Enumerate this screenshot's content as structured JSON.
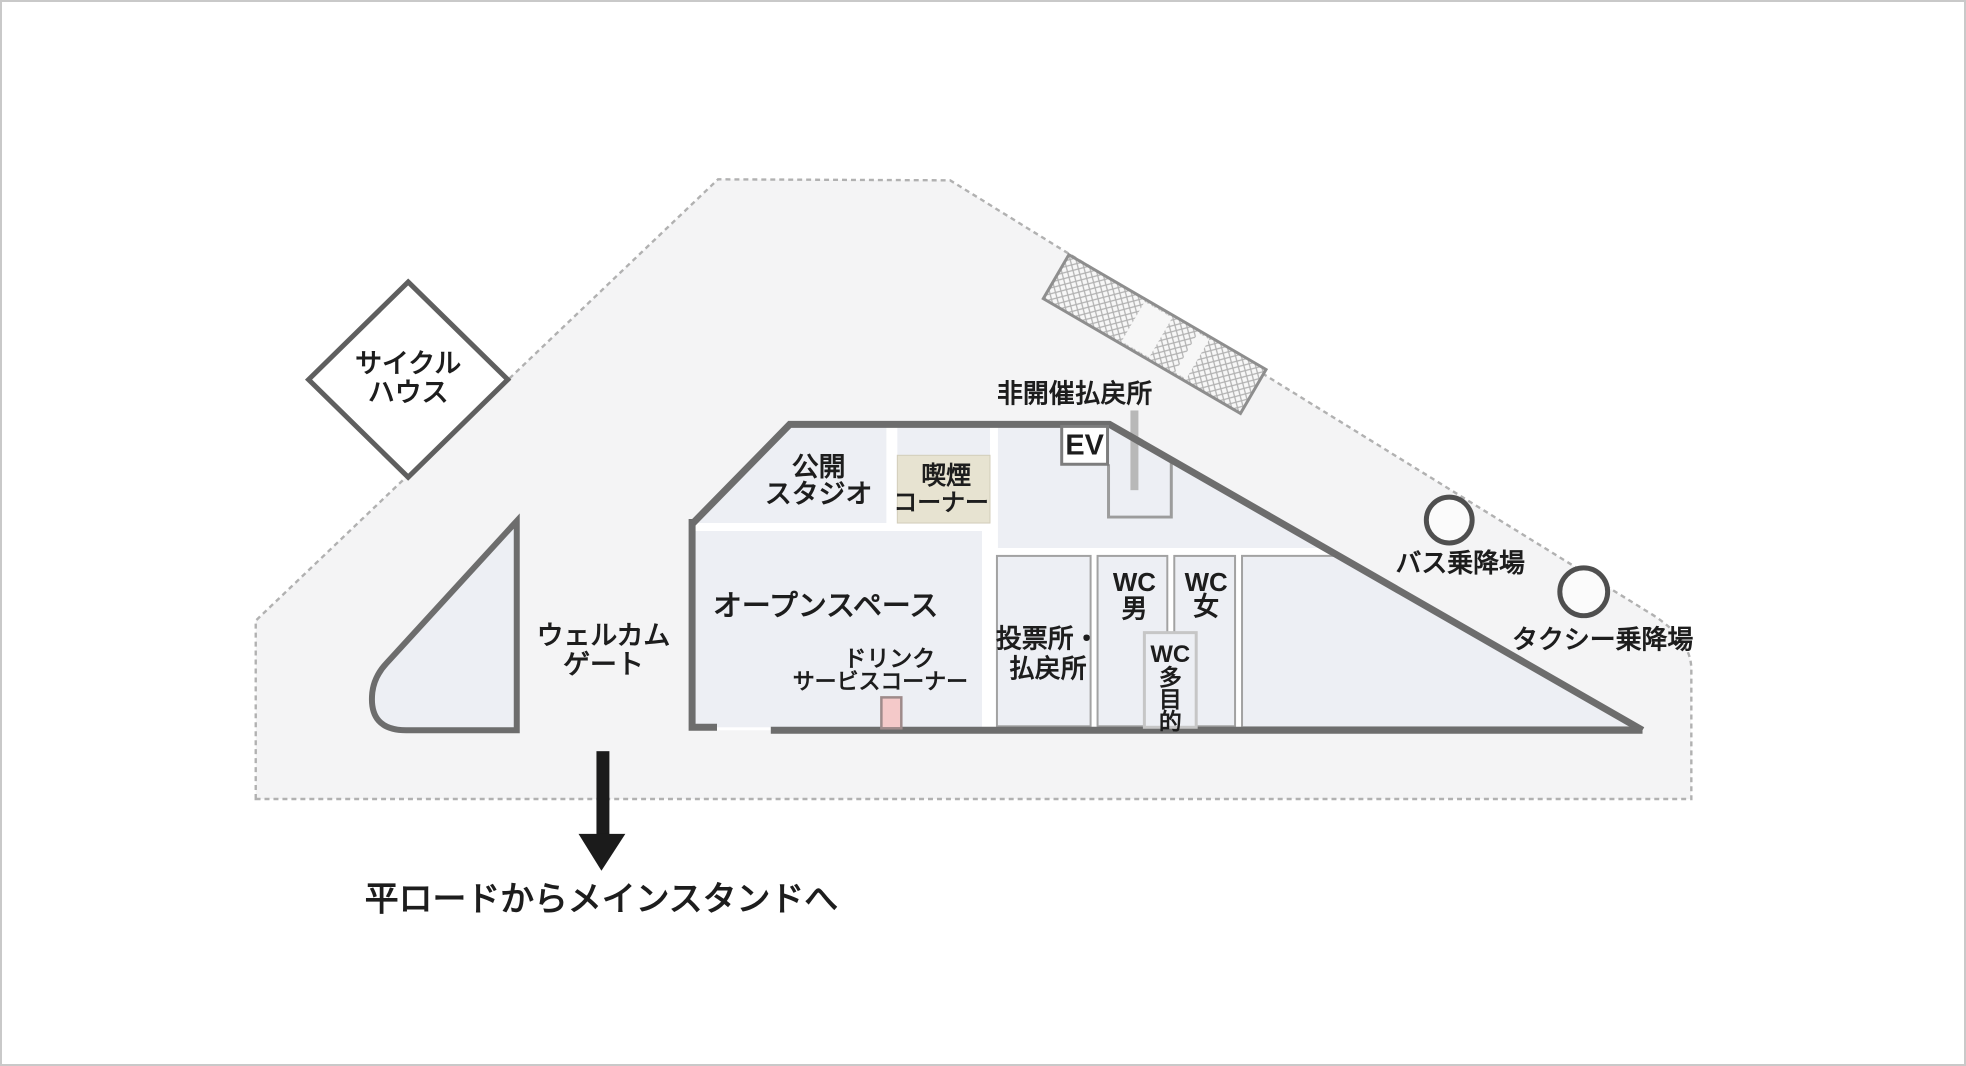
{
  "colors": {
    "area_fill": "#f4f4f5",
    "area_border": "#b1b1b1",
    "wall": "#6d6d6d",
    "room_fill": "#edeff4",
    "smoking_fill": "#e7e3d1",
    "counter_fill": "#f4c9c9",
    "leader_line": "#b8b8b8",
    "text": "#1d1d1d"
  },
  "labels": {
    "cycle_house_line1": "サイクル",
    "cycle_house_line2": "ハウス",
    "public_studio_line1": "公開",
    "public_studio_line2": "スタジオ",
    "smoking_line1": "喫煙",
    "smoking_line2": "コーナー",
    "ev": "EV",
    "offday_refund": "非開催払戻所",
    "open_space": "オープンスペース",
    "drink_line1": "ドリンク",
    "drink_line2": "サービスコーナー",
    "betting_line1": "投票所・",
    "betting_line2": "払戻所",
    "wc_men_line1": "WC",
    "wc_men_line2": "男",
    "wc_women_line1": "WC",
    "wc_women_line2": "女",
    "wc_multi_line1": "WC",
    "wc_multi_line2": "多",
    "wc_multi_line3": "目",
    "wc_multi_line4": "的",
    "welcome_line1": "ウェルカム",
    "welcome_line2": "ゲート",
    "bus_stop": "バス乗降場",
    "taxi_stop": "タクシー乗降場",
    "route_note": "平ロードからメインスタンドへ"
  }
}
